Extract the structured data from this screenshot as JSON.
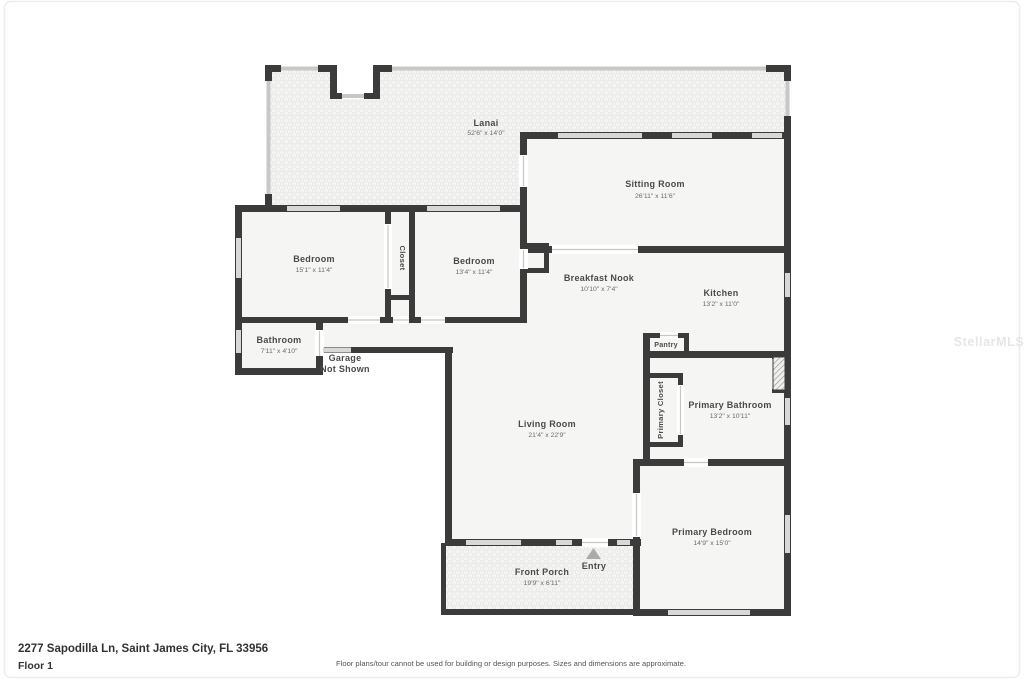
{
  "watermark": "StellarMLS",
  "footer": {
    "address": "2277 Sapodilla Ln, Saint James City, FL 33956",
    "floor_label": "Floor 1",
    "disclaimer": "Floor plans/tour cannot be used for building or design purposes. Sizes and dimensions are approximate."
  },
  "rooms": {
    "lanai": {
      "name": "Lanai",
      "dims": "52'6\" x 14'0\""
    },
    "sitting_room": {
      "name": "Sitting Room",
      "dims": "26'11\" x 11'6\""
    },
    "bedroom_left": {
      "name": "Bedroom",
      "dims": "15'1\" x 11'4\""
    },
    "closet": {
      "name": "Closet"
    },
    "bedroom_mid": {
      "name": "Bedroom",
      "dims": "13'4\" x 11'4\""
    },
    "breakfast_nook": {
      "name": "Breakfast Nook",
      "dims": "10'10\" x 7'4\""
    },
    "kitchen": {
      "name": "Kitchen",
      "dims": "13'2\" x 11'0\""
    },
    "pantry": {
      "name": "Pantry"
    },
    "bathroom": {
      "name": "Bathroom",
      "dims": "7'11\" x 4'10\""
    },
    "garage": {
      "line1": "Garage",
      "line2": "Not Shown"
    },
    "primary_closet": {
      "name": "Primary Closet"
    },
    "primary_bathroom": {
      "name": "Primary Bathroom",
      "dims": "13'2\" x 10'11\""
    },
    "living_room": {
      "name": "Living Room",
      "dims": "21'4\" x 22'9\""
    },
    "primary_bedroom": {
      "name": "Primary Bedroom",
      "dims": "14'9\" x 15'0\""
    },
    "front_porch": {
      "name": "Front Porch",
      "dims": "19'9\" x 6'11\""
    },
    "entry": {
      "name": "Entry"
    }
  },
  "colors": {
    "wall": "#3b3b3b",
    "room_fill": "#f5f5f4",
    "screen": "#c8c8c8",
    "window": "#d8d8d8",
    "opening_line": "#c6c6c6",
    "label": "#4a4a4a",
    "dims": "#6b6b6b",
    "entry_marker": "#ababab",
    "watermark": "#dedede",
    "footer_text": "#333333",
    "disclaimer_text": "#555555"
  }
}
